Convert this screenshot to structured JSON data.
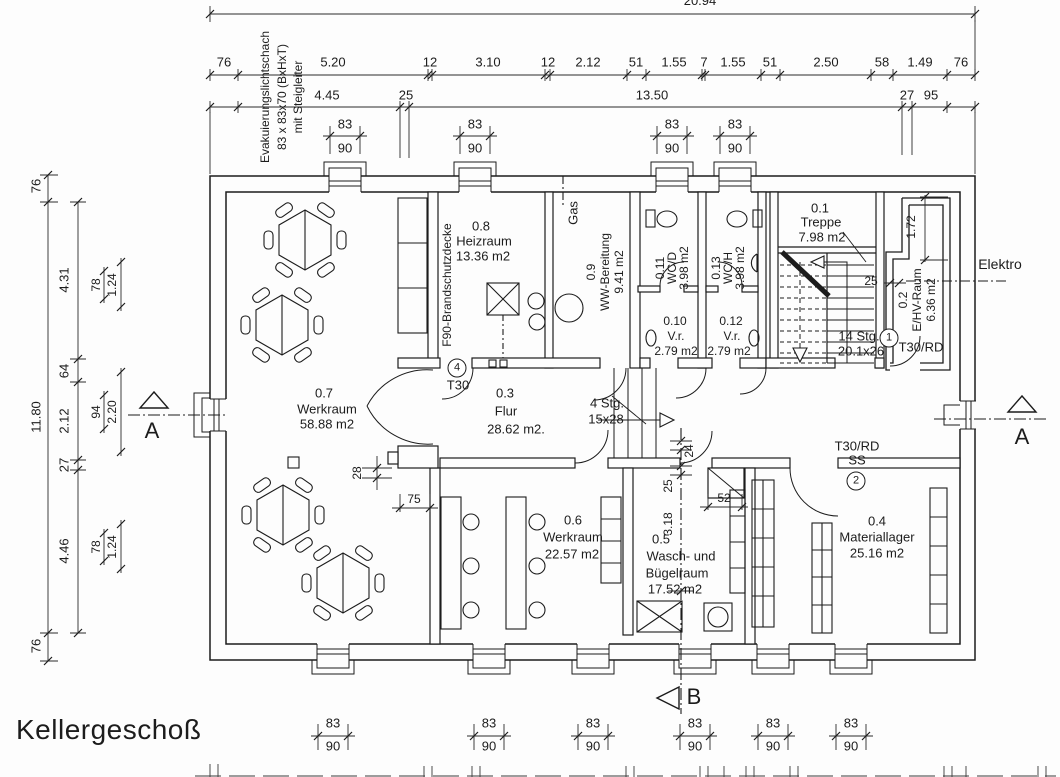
{
  "title": "Kellergeschoß",
  "annotations": {
    "evac_line1": "Evakuierungslichtschach",
    "evac_line2": "83 x 83x70 (BxHxT)",
    "evac_line3": "mit Steigleiter",
    "gas": "Gas",
    "elektro": "Elektro",
    "f90": "F90-Brandschutzdecke",
    "stairs_main_line1": "14 Stg.",
    "stairs_main_line2": "20.1x26",
    "stairs_small_line1": "4 Stg.",
    "stairs_small_line2": "15x28"
  },
  "sections": {
    "a_left": "A",
    "a_right": "A",
    "b_bottom": "B"
  },
  "doors": {
    "d1_num": "1",
    "d1_label": "T30/RD",
    "d2_num": "2",
    "d2_label": "T30/RD",
    "d2_label2": "SS",
    "d4_num": "4",
    "d4_label": "T30"
  },
  "rooms": {
    "r01": {
      "num": "0.1",
      "name": "Treppe",
      "area": "7.98 m2"
    },
    "r02": {
      "num": "0.2",
      "name": "E/HV-Raum",
      "area": "6.36 m2"
    },
    "r03": {
      "num": "0.3",
      "name": "Flur",
      "area": "28.62 m2."
    },
    "r04": {
      "num": "0.4",
      "name": "Materiallager",
      "area": "25.16 m2"
    },
    "r05": {
      "num": "0.5",
      "name_line1": "Wasch- und",
      "name_line2": "Bügelraum",
      "area": "17.52 m2"
    },
    "r06": {
      "num": "0.6",
      "name": "Werkraum",
      "area": "22.57 m2"
    },
    "r07": {
      "num": "0.7",
      "name": "Werkraum",
      "area": "58.88 m2"
    },
    "r08": {
      "num": "0.8",
      "name": "Heizraum",
      "area": "13.36 m2"
    },
    "r09": {
      "num": "0.9",
      "name": "WW-Bereitung",
      "area": "9.41 m2"
    },
    "r010": {
      "num": "0.10",
      "name": "V.r.",
      "area": "2.79 m2"
    },
    "r011": {
      "num": "0.11",
      "name": "WC/D",
      "area": "3.98 m2"
    },
    "r012": {
      "num": "0.12",
      "name": "V.r.",
      "area": "2.79 m2"
    },
    "r013": {
      "num": "0.13",
      "name": "WC/H",
      "area": "3.98 m2"
    }
  },
  "dims": {
    "overall_top": "20.94",
    "top_row1": [
      "76",
      "5.20",
      "12",
      "3.10",
      "12",
      "2.12",
      "51",
      "1.55",
      "7",
      "1.55",
      "51",
      "2.50",
      "58",
      "1.49",
      "76"
    ],
    "top_row2": [
      "4.45",
      "25",
      "13.50",
      "27",
      "95"
    ],
    "left_outer": [
      "76",
      "11.80",
      "76"
    ],
    "left_chain": [
      "4.31",
      "64",
      "2.12",
      "27",
      "4.46"
    ],
    "left_inner_top": [
      "78",
      "1.24"
    ],
    "left_inner_mid": [
      "94",
      "2.20"
    ],
    "left_inner_bot": [
      "78",
      "1.24"
    ],
    "win_w": "83",
    "win_h": "90",
    "d_28": "28",
    "d_75": "75",
    "d_24": "24",
    "d_25a": "25",
    "d_318": "3.18",
    "d_52": "52",
    "d_25b": "25",
    "d_172": "1.72"
  }
}
